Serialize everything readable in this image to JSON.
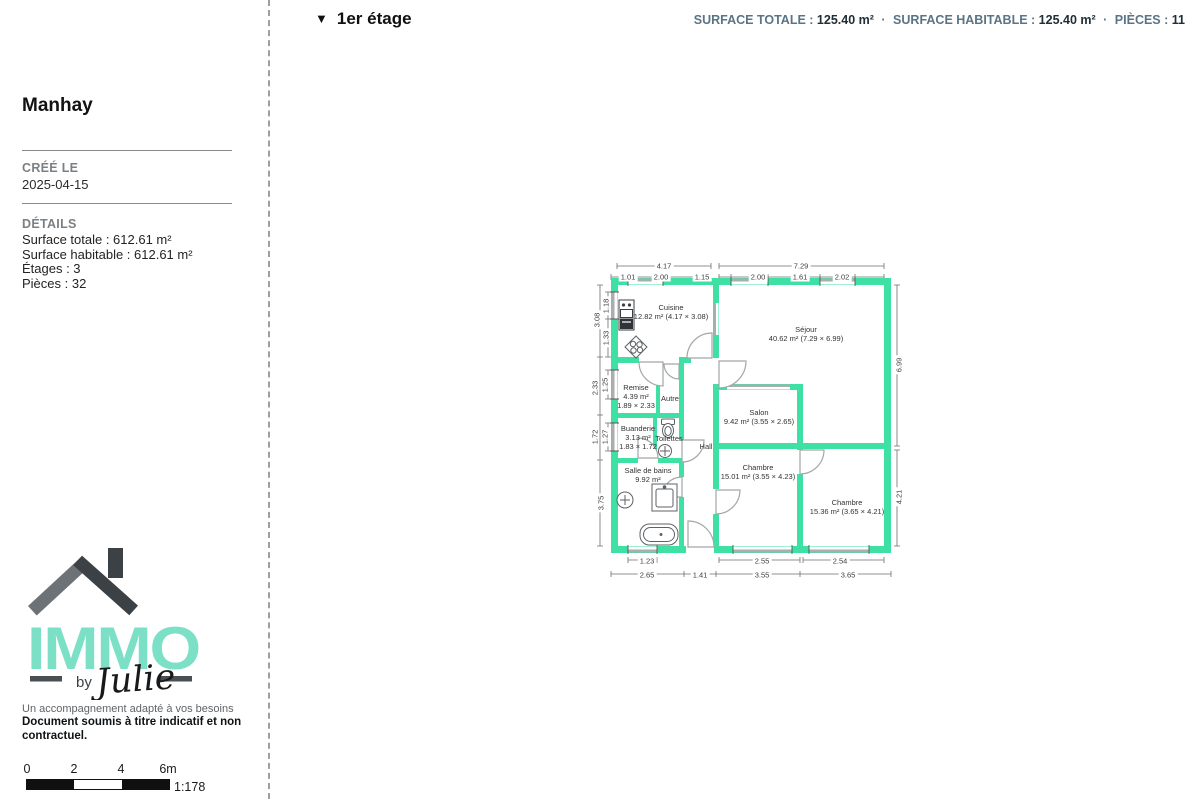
{
  "header": {
    "collapse_icon": "▼",
    "floor_label": "1er étage",
    "sep": "·",
    "stats": [
      {
        "label": "SURFACE TOTALE :",
        "value": "125.40 m²"
      },
      {
        "label": "SURFACE HABITABLE :",
        "value": "125.40 m²"
      },
      {
        "label": "PIÈCES :",
        "value": "11"
      }
    ]
  },
  "sidebar": {
    "title": "Manhay",
    "created_label": "CRÉÉ LE",
    "created_value": "2025-04-15",
    "details_label": "DÉTAILS",
    "details": [
      "Surface totale : 612.61 m²",
      "Surface habitable : 612.61 m²",
      "Étages : 3",
      "Pièces : 32"
    ],
    "logo": {
      "brand": "IMMO",
      "by": "by",
      "name": "Julie",
      "brand_color": "#7CE0C6"
    },
    "tagline": "Un accompagnement adapté à vos besoins",
    "disclaimer": "Document soumis à titre indicatif et non contractuel."
  },
  "scalebar": {
    "ticks": [
      "0",
      "2",
      "4",
      "6m"
    ],
    "ratio": "1:178"
  },
  "floorplan": {
    "wall_color": "#3FE0A4",
    "rooms": [
      {
        "name": "Cuisine",
        "details": "12.82 m² (4.17 × 3.08)"
      },
      {
        "name": "Séjour",
        "details": "40.62 m² (7.29 × 6.99)"
      },
      {
        "name": "Remise",
        "details": "4.39 m²",
        "dims": "1.89 × 2.33"
      },
      {
        "name": "Autre"
      },
      {
        "name": "Buanderie",
        "details": "3.13 m²",
        "dims": "1.83 × 1.72"
      },
      {
        "name": "Toilettes"
      },
      {
        "name": "Hall"
      },
      {
        "name": "Salle de bains",
        "details": "9.92 m²"
      },
      {
        "name": "Salon",
        "details": "9.42 m² (3.55 × 2.65)"
      },
      {
        "name": "Chambre",
        "details": "15.01 m² (3.55 × 4.23)"
      },
      {
        "name": "Chambre",
        "details": "15.36 m² (3.65 × 4.21)"
      }
    ],
    "dim_labels": [
      {
        "t": "4.17",
        "x": 664,
        "y": 266
      },
      {
        "t": "7.29",
        "x": 801,
        "y": 266
      },
      {
        "t": "1.01",
        "x": 628,
        "y": 277
      },
      {
        "t": "2.00",
        "x": 661,
        "y": 277
      },
      {
        "t": "1.15",
        "x": 702,
        "y": 277
      },
      {
        "t": "2.00",
        "x": 758,
        "y": 277
      },
      {
        "t": "1.61",
        "x": 800,
        "y": 277
      },
      {
        "t": "2.02",
        "x": 842,
        "y": 277
      },
      {
        "t": "3.08",
        "x": 597,
        "y": 320,
        "r": 1
      },
      {
        "t": "1.18",
        "x": 606,
        "y": 306,
        "r": 1
      },
      {
        "t": "1.33",
        "x": 606,
        "y": 338,
        "r": 1
      },
      {
        "t": "2.33",
        "x": 595,
        "y": 388,
        "r": 1
      },
      {
        "t": "1.25",
        "x": 605,
        "y": 385,
        "r": 1
      },
      {
        "t": "1.72",
        "x": 595,
        "y": 437,
        "r": 1
      },
      {
        "t": "1.27",
        "x": 605,
        "y": 437,
        "r": 1
      },
      {
        "t": "3.75",
        "x": 601,
        "y": 503,
        "r": 1
      },
      {
        "t": "6.99",
        "x": 899,
        "y": 365,
        "r": 1
      },
      {
        "t": "4.21",
        "x": 899,
        "y": 497,
        "r": 1
      },
      {
        "t": "1.23",
        "x": 647,
        "y": 561
      },
      {
        "t": "2.55",
        "x": 762,
        "y": 561
      },
      {
        "t": "2.54",
        "x": 840,
        "y": 561
      },
      {
        "t": "2.65",
        "x": 647,
        "y": 575
      },
      {
        "t": "1.41",
        "x": 700,
        "y": 575
      },
      {
        "t": "3.55",
        "x": 762,
        "y": 575
      },
      {
        "t": "3.65",
        "x": 848,
        "y": 575
      }
    ]
  }
}
